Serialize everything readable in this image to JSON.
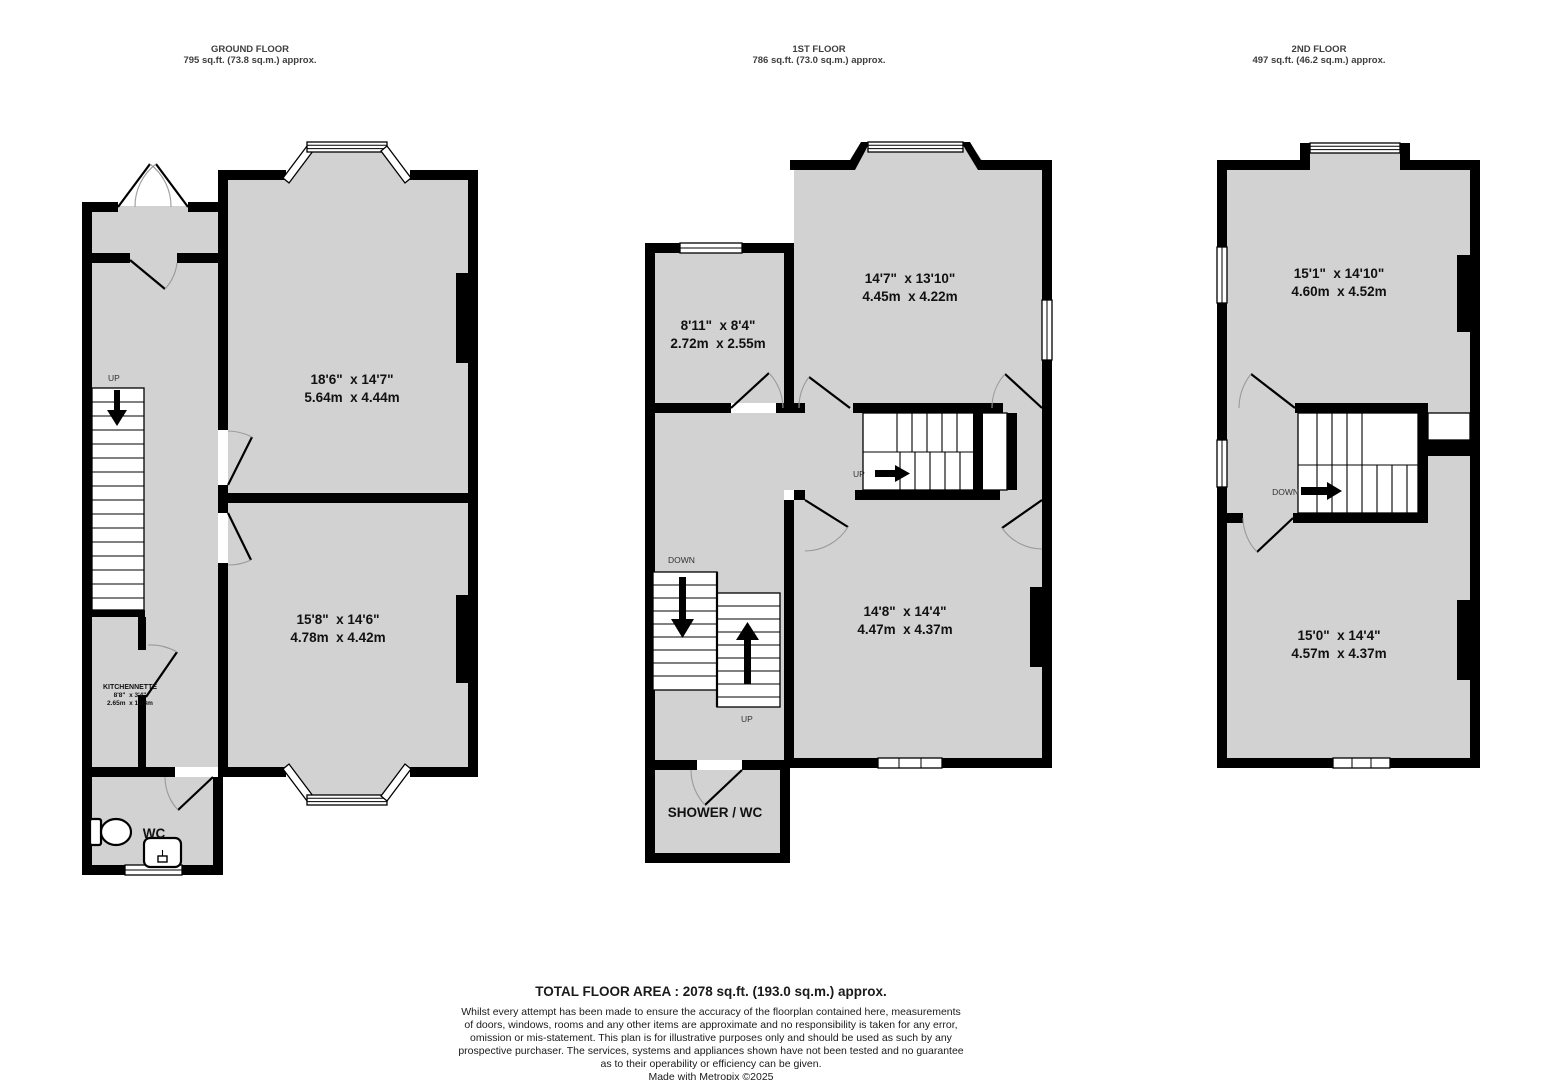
{
  "ground": {
    "title": "GROUND FLOOR",
    "area": "795 sq.ft. (73.8 sq.m.) approx.",
    "front_room_imperial": "18'6\"  x 14'7\"",
    "front_room_metric": "5.64m  x 4.44m",
    "back_room_imperial": "15'8\"  x 14'6\"",
    "back_room_metric": "4.78m  x 4.42m",
    "kitchennette_name": "KITCHENNETTE",
    "kitchennette_imperial": "8'8\"  x 3'4\"",
    "kitchennette_metric": "2.65m  x 1.03m",
    "wc": "WC",
    "up": "UP"
  },
  "first": {
    "title": "1ST FLOOR",
    "area": "786 sq.ft. (73.0 sq.m.) approx.",
    "front_room_imperial": "14'7\"  x 13'10\"",
    "front_room_metric": "4.45m  x 4.22m",
    "small_room_imperial": "8'11\"  x 8'4\"",
    "small_room_metric": "2.72m  x 2.55m",
    "back_room_imperial": "14'8\"  x 14'4\"",
    "back_room_metric": "4.47m  x 4.37m",
    "shower": "SHOWER / WC",
    "up_mid": "UP",
    "down": "DOWN",
    "up_left": "UP"
  },
  "second": {
    "title": "2ND FLOOR",
    "area": "497 sq.ft. (46.2 sq.m.) approx.",
    "front_room_imperial": "15'1\"  x 14'10\"",
    "front_room_metric": "4.60m  x 4.52m",
    "back_room_imperial": "15'0\"  x 14'4\"",
    "back_room_metric": "4.57m  x 4.37m",
    "down": "DOWN"
  },
  "footer": {
    "total": "TOTAL FLOOR AREA : 2078 sq.ft. (193.0 sq.m.) approx.",
    "line1": "Whilst every attempt has been made to ensure the accuracy of the floorplan contained here, measurements",
    "line2": "of doors, windows, rooms and any other items are approximate and no responsibility is taken for any error,",
    "line3": "omission or mis-statement. This plan is for illustrative purposes only and should be used as such by any",
    "line4": "prospective purchaser. The services, systems and appliances shown have not been tested and no guarantee",
    "line5": "as to their operability or efficiency can be given.",
    "credit": "Made with Metropix ©2025"
  },
  "colors": {
    "wall": "#000000",
    "room_fill": "#d2d2d2",
    "text": "#111111"
  }
}
